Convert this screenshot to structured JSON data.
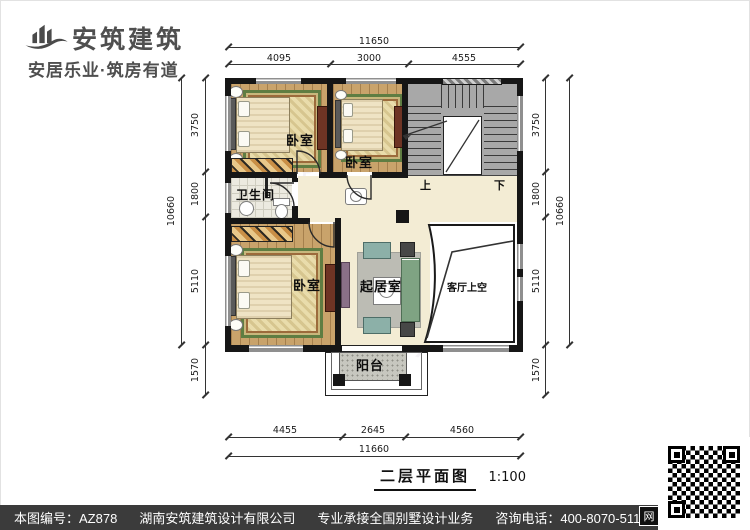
{
  "logo": {
    "name": "安筑建筑",
    "tagline": "安居乐业·筑房有道"
  },
  "plan": {
    "rooms": {
      "bedroom_top_left": "卧室",
      "bedroom_top_mid": "卧室",
      "bedroom_bottom_left": "卧室",
      "bathroom": "卫生间",
      "living": "起居室",
      "void_above_living": "客厅上空",
      "balcony": "阳台",
      "stair_up": "上",
      "stair_down": "下"
    },
    "dims": {
      "top": {
        "total": "11650",
        "segments": [
          "4095",
          "3000",
          "4555"
        ]
      },
      "bottom": {
        "total": "11660",
        "segments": [
          "4455",
          "2645",
          "4560"
        ]
      },
      "left": {
        "total": "10660",
        "segments": [
          "3750",
          "1800",
          "5110",
          "1570"
        ]
      },
      "right": {
        "total": "10660",
        "segments": [
          "3750",
          "1800",
          "5110",
          "1570"
        ]
      }
    },
    "watermark": "安筑建筑"
  },
  "title": {
    "text": "二层平面图",
    "scale": "1:100"
  },
  "footer": {
    "drawing_no": "本图编号：AZ878",
    "company": "湖南安筑建筑设计有限公司",
    "service": "专业承接全国别墅设计业务",
    "phone": "咨询电话：400-8070-511",
    "web_badge": "网"
  },
  "colors": {
    "wall": "#161616",
    "wood_floor": "#c9a36b",
    "tile_floor": "#f3ecd4",
    "stair": "#a8a8a8",
    "rug_border_green": "#5f7d42",
    "footer_bar": "#3b3b3b"
  }
}
